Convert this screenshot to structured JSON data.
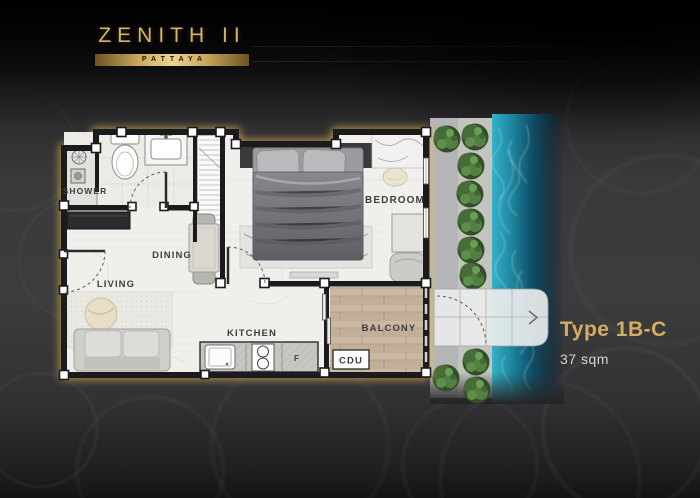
{
  "brand": {
    "name": "ZENITH II",
    "location": "PATTAYA"
  },
  "unit": {
    "type": "Type 1B-C",
    "area": "37 sqm"
  },
  "plan": {
    "labels": {
      "shower": "SHOWER",
      "dining": "DINING",
      "living": "LIVING",
      "kitchen": "KITCHEN",
      "bedroom": "BEDROOM",
      "balcony": "BALCONY",
      "cdu": "CDU",
      "fridge": "F"
    }
  },
  "colors": {
    "gold_accent": "#d4ad62",
    "plan_glow": "#efb952",
    "wall": "#1b1b1e",
    "floor": "#f1efec",
    "balcony_wood": "#c9b7a2",
    "pool_water": "#2ea7bd",
    "walkway": "#b4b5b6",
    "tree_green": "#4c7140",
    "background": "#39393b"
  }
}
